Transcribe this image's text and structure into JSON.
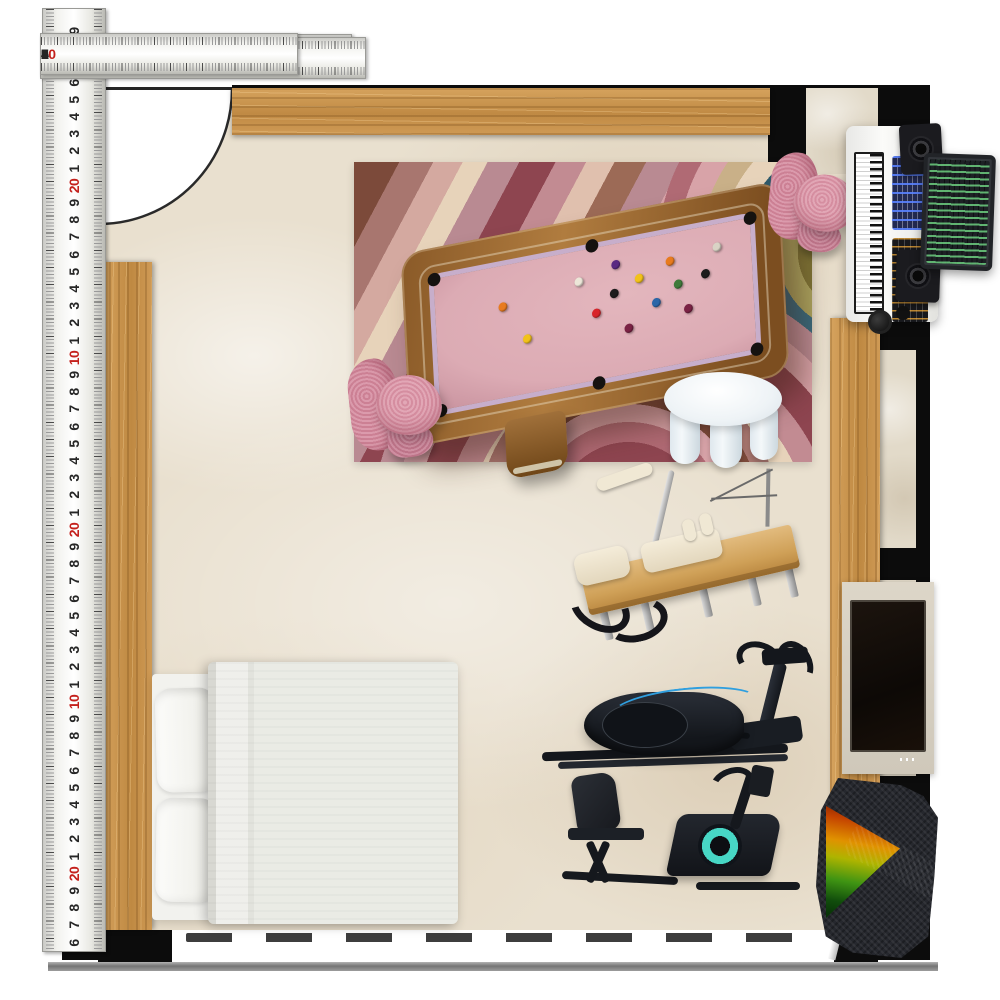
{
  "scene": {
    "type": "floor-plan-mood-board",
    "description_items": [
      "rug",
      "pool-table",
      "swivel-chair",
      "side-table",
      "pilates-reformer",
      "elliptical-trainer",
      "recumbent-bike",
      "bed",
      "music-workstation",
      "tv",
      "practice-net"
    ]
  },
  "colors": {
    "wall": "#0c0c0c",
    "floor": "#e9e0cf",
    "rug-mauve": "#b98a92",
    "rug-pink": "#d4929b",
    "felt": "#dcabb4",
    "chair-pink": "#d58a9e",
    "elliptical-accent": "#2f9fdf",
    "bike-accent": "#47d7c5",
    "ruler-ink": "#262626",
    "ruler-red": "#c4201c"
  },
  "rulers": {
    "top": {
      "segments": [
        {
          "numbers": [
            "1",
            "2",
            "3",
            "4",
            "5",
            "6",
            "7",
            "8",
            "9",
            "10",
            "1",
            "2",
            "3",
            "4",
            "5",
            "6",
            "7",
            "8",
            "9",
            "20"
          ],
          "red": [
            "10",
            "20"
          ]
        },
        {
          "numbers": [
            "1",
            "2",
            "3",
            "4",
            "5",
            "6",
            "7",
            "8",
            "9",
            "10",
            "1",
            "2",
            "3",
            "4",
            "5",
            "6",
            "7",
            "8",
            "9",
            "20"
          ],
          "red": [
            "10",
            "20"
          ]
        },
        {
          "numbers": [
            "1",
            "2",
            "3",
            "4",
            "5",
            "6",
            "7",
            "8",
            "9",
            "10",
            "1",
            "2",
            "3",
            "4",
            "5",
            "6"
          ],
          "red": [
            "10"
          ]
        }
      ]
    },
    "left": {
      "numbers": [
        "9",
        "8",
        "7",
        "6",
        "5",
        "4",
        "3",
        "2",
        "1",
        "20",
        "9",
        "8",
        "7",
        "6",
        "5",
        "4",
        "3",
        "2",
        "1",
        "10",
        "9",
        "8",
        "7",
        "6",
        "5",
        "4",
        "3",
        "2",
        "1",
        "20",
        "9",
        "8",
        "7",
        "6",
        "5",
        "4",
        "3",
        "2",
        "1",
        "10",
        "9",
        "8",
        "7",
        "6",
        "5",
        "4",
        "3",
        "2",
        "1",
        "20",
        "9",
        "8",
        "7",
        "6"
      ],
      "red": [
        "10",
        "20"
      ]
    }
  },
  "pool_table": {
    "felt": "#dcabb4",
    "balls": [
      {
        "x": 20,
        "y": 28,
        "c": "#e87b1e"
      },
      {
        "x": 27,
        "y": 55,
        "c": "#f2c21a"
      },
      {
        "x": 44,
        "y": 20,
        "c": "#ece6d8"
      },
      {
        "x": 49,
        "y": 46,
        "c": "#d8242a"
      },
      {
        "x": 55,
        "y": 34,
        "c": "#1c1c1c"
      },
      {
        "x": 59,
        "y": 62,
        "c": "#7a2244"
      },
      {
        "x": 63,
        "y": 26,
        "c": "#f2c21a"
      },
      {
        "x": 68,
        "y": 47,
        "c": "#2a66a8"
      },
      {
        "x": 73,
        "y": 18,
        "c": "#e87b1e"
      },
      {
        "x": 78,
        "y": 56,
        "c": "#7a2244"
      },
      {
        "x": 84,
        "y": 32,
        "c": "#1c1c1c"
      },
      {
        "x": 88,
        "y": 14,
        "c": "#d9d3c5"
      },
      {
        "x": 56,
        "y": 12,
        "c": "#5a2a82"
      },
      {
        "x": 75,
        "y": 36,
        "c": "#3f7a3a"
      }
    ],
    "pockets": [
      {
        "x": 0,
        "y": 0
      },
      {
        "x": 50,
        "y": -2
      },
      {
        "x": 100,
        "y": 0
      },
      {
        "x": 0,
        "y": 100
      },
      {
        "x": 50,
        "y": 102
      },
      {
        "x": 100,
        "y": 100
      }
    ]
  }
}
